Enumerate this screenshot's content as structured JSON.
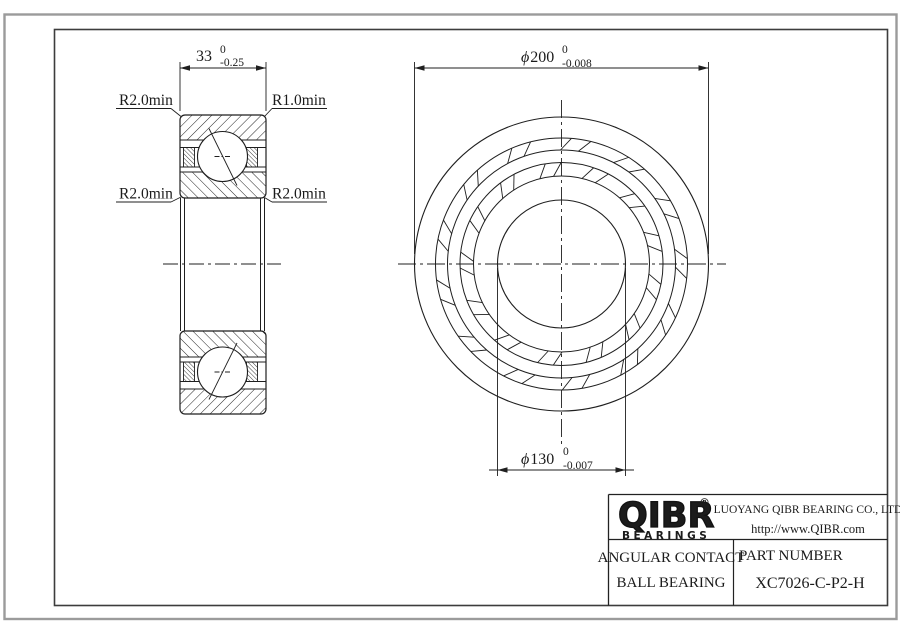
{
  "dimensions": {
    "width": {
      "value": "33",
      "tol_upper": "0",
      "tol_lower": "-0.25"
    },
    "outer_diameter": {
      "symbol": "ϕ",
      "value": "200",
      "tol_upper": "0",
      "tol_lower": "-0.008"
    },
    "bore_diameter": {
      "symbol": "ϕ",
      "value": "130",
      "tol_upper": "0",
      "tol_lower": "-0.007"
    },
    "fillet_top_left": "R2.0min",
    "fillet_top_right": "R1.0min",
    "fillet_mid_left": "R2.0min",
    "fillet_mid_right": "R2.0min"
  },
  "title_block": {
    "brand": "QIBR",
    "brand_mark": "®",
    "brand_sub": "BEARINGS",
    "company": "LUOYANG QIBR BEARING CO., LTD",
    "website": "http://www.QIBR.com",
    "product_type_line1": "ANGULAR CONTACT",
    "product_type_line2": "BALL BEARING",
    "part_number_label": "PART NUMBER",
    "part_number": "XC7026-C-P2-H"
  },
  "colors": {
    "line": "#1f1f1f",
    "frame_outer": "#9b9b9b",
    "frame_inner": "#3d3d3d",
    "background": "#ffffff"
  }
}
